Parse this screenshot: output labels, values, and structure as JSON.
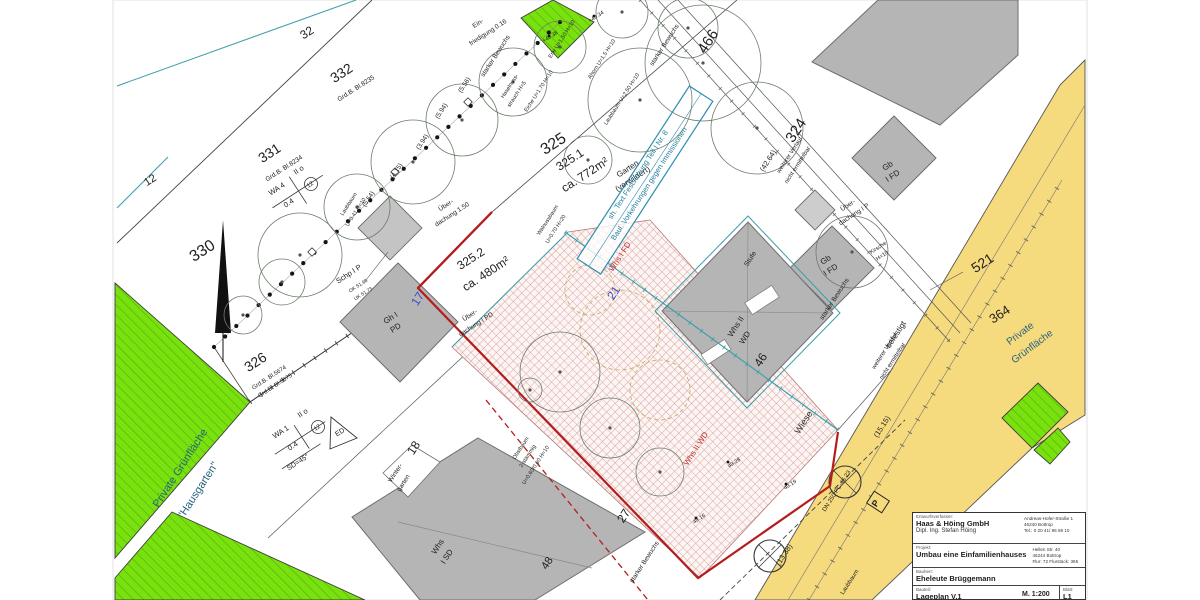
{
  "title_block": {
    "designer_label": "Entwurfsverfasser:",
    "designer_name": "Haas & Höing GmbH",
    "designer_person": "Dipl. Ing. Stefan Höing",
    "designer_addr1": "Andreas-Hofer-Straße 1",
    "designer_addr2": "46240 Bottrop",
    "designer_addr3": "Tel.: 0 20 41/ 96 69 10",
    "project_label": "Projekt:",
    "project_name": "Umbau eine Einfamilienhauses",
    "project_addr1": "Hellen Str. 40",
    "project_addr2": "46244 Bottrop",
    "project_addr3": "Flur: 72   Flurstück: 365",
    "client_label": "Bauherr:",
    "client_name": "Eheleute Brüggemann",
    "part_label": "Bauteil:",
    "part_name": "Lageplan V.1",
    "scale": "M. 1:200",
    "sheet_label": "Blatt:",
    "sheet": "L1"
  },
  "colors": {
    "green_area": "#79e20e",
    "green_hatch": "#5cb80b",
    "street_yellow": "#f5da7e",
    "building_grey": "#b5b5b5",
    "boundary_red": "#b51d1d",
    "hatch_pink": "#cf8f8c",
    "teal_line": "#3a9ea8",
    "green_text": "#27637d",
    "note_blue": "#1f7e9c",
    "blue_number": "#3b4fc0",
    "red_label": "#c03030"
  },
  "plan": {
    "labels": [
      {
        "name": "parcel-330",
        "text": "330",
        "x": 205,
        "y": 255,
        "rot": -33,
        "size": 16
      },
      {
        "name": "parcel-331",
        "text": "331",
        "x": 272,
        "y": 157,
        "rot": -33,
        "size": 14
      },
      {
        "name": "grundbuch-331",
        "text": "Grd.B. Bl.8234",
        "x": 285,
        "y": 170,
        "rot": -33,
        "size": 6.5
      },
      {
        "name": "parcel-332",
        "text": "332",
        "x": 344,
        "y": 77,
        "rot": -33,
        "size": 14
      },
      {
        "name": "grundbuch-332",
        "text": "Grd.B. Bl.8235",
        "x": 357,
        "y": 90,
        "rot": -33,
        "size": 6.5
      },
      {
        "name": "parcel-32",
        "text": "32",
        "x": 309,
        "y": 36,
        "rot": -33,
        "size": 12
      },
      {
        "name": "parcel-12",
        "text": "12",
        "x": 152,
        "y": 183,
        "rot": -33,
        "size": 11
      },
      {
        "name": "parcel-326",
        "text": "326",
        "x": 258,
        "y": 366,
        "rot": -33,
        "size": 14
      },
      {
        "name": "grundbuch-326a",
        "text": "Grd.B. Bl.5674",
        "x": 270,
        "y": 379,
        "rot": -33,
        "size": 6
      },
      {
        "name": "grundbuch-326b",
        "text": "Grd.B. Bl.5675",
        "x": 276,
        "y": 387,
        "rot": -33,
        "size": 6
      },
      {
        "name": "parcel-325",
        "text": "325",
        "x": 556,
        "y": 148,
        "rot": -33,
        "size": 16
      },
      {
        "name": "parcel-325-1",
        "text": "325.1",
        "x": 572,
        "y": 163,
        "rot": -33,
        "size": 12
      },
      {
        "name": "area-325-1",
        "text": "ca. 772m²",
        "x": 587,
        "y": 178,
        "rot": -33,
        "size": 12
      },
      {
        "name": "garten-label-1",
        "text": "Garten",
        "x": 629,
        "y": 171,
        "rot": -33,
        "size": 8
      },
      {
        "name": "garten-label-2",
        "text": "(verwildert)",
        "x": 634,
        "y": 181,
        "rot": -33,
        "size": 8
      },
      {
        "name": "parcel-325-2",
        "text": "325.2",
        "x": 473,
        "y": 262,
        "rot": -33,
        "size": 12
      },
      {
        "name": "area-325-2",
        "text": "ca. 480m²",
        "x": 488,
        "y": 277,
        "rot": -33,
        "size": 12
      },
      {
        "name": "parcel-324",
        "text": "324",
        "x": 800,
        "y": 133,
        "rot": -57,
        "size": 15
      },
      {
        "name": "parcel-466",
        "text": "466",
        "x": 712,
        "y": 44,
        "rot": -57,
        "size": 15
      },
      {
        "name": "parcel-521",
        "text": "521",
        "x": 985,
        "y": 267,
        "rot": -33,
        "size": 14
      },
      {
        "name": "parcel-364",
        "text": "364",
        "x": 1002,
        "y": 318,
        "rot": -33,
        "size": 13
      },
      {
        "name": "green-right-label-1",
        "text": "Private",
        "x": 1022,
        "y": 336,
        "rot": -37,
        "size": 10,
        "color": "#27637d"
      },
      {
        "name": "green-right-label-2",
        "text": "Grünfläche",
        "x": 1034,
        "y": 349,
        "rot": -37,
        "size": 10,
        "color": "#27637d"
      },
      {
        "name": "green-left-label-1",
        "text": "Private Grünfläche",
        "x": 183,
        "y": 470,
        "rot": -57,
        "size": 11,
        "color": "#27637d"
      },
      {
        "name": "green-left-label-2",
        "text": "\"Hausgarten\"",
        "x": 201,
        "y": 492,
        "rot": -57,
        "size": 11,
        "color": "#27637d"
      },
      {
        "name": "parcel-18",
        "text": "18",
        "x": 417,
        "y": 450,
        "rot": -57,
        "size": 12
      },
      {
        "name": "housenr-17",
        "text": "17",
        "x": 421,
        "y": 301,
        "rot": -57,
        "size": 12,
        "color": "#3b4fc0"
      },
      {
        "name": "housenr-21",
        "text": "21",
        "x": 617,
        "y": 295,
        "rot": -57,
        "size": 12,
        "color": "#3b4fc0"
      },
      {
        "name": "housenr-27",
        "text": "27",
        "x": 627,
        "y": 518,
        "rot": -57,
        "size": 12
      },
      {
        "name": "housenr-46",
        "text": "46",
        "x": 764,
        "y": 362,
        "rot": -57,
        "size": 12
      },
      {
        "name": "whs46-label-1",
        "text": "Whs II",
        "x": 738,
        "y": 328,
        "rot": -57,
        "size": 8
      },
      {
        "name": "whs46-label-2",
        "text": "WD",
        "x": 747,
        "y": 339,
        "rot": -57,
        "size": 8
      },
      {
        "name": "housenr-48",
        "text": "48",
        "x": 550,
        "y": 565,
        "rot": -57,
        "size": 11
      },
      {
        "name": "whs48-label-1",
        "text": "Whs",
        "x": 440,
        "y": 548,
        "rot": -57,
        "size": 8
      },
      {
        "name": "whs48-label-2",
        "text": "I SD",
        "x": 449,
        "y": 558,
        "rot": -57,
        "size": 8
      },
      {
        "name": "wintergarten-1",
        "text": "Winter-",
        "x": 397,
        "y": 474,
        "rot": -57,
        "size": 6.5
      },
      {
        "name": "wintergarten-2",
        "text": "garten",
        "x": 405,
        "y": 484,
        "rot": -57,
        "size": 6.5
      },
      {
        "name": "gb1-label-1",
        "text": "Gb",
        "x": 889,
        "y": 168,
        "rot": -33,
        "size": 8
      },
      {
        "name": "gb1-label-2",
        "text": "I FD",
        "x": 894,
        "y": 178,
        "rot": -33,
        "size": 8
      },
      {
        "name": "gb2-label-1",
        "text": "Gb",
        "x": 827,
        "y": 262,
        "rot": -33,
        "size": 8
      },
      {
        "name": "gb2-label-2",
        "text": "I FD",
        "x": 832,
        "y": 272,
        "rot": -33,
        "size": 8
      },
      {
        "name": "gh-label-1",
        "text": "Gh I",
        "x": 392,
        "y": 320,
        "rot": -33,
        "size": 8
      },
      {
        "name": "gh-label-2",
        "text": "PD",
        "x": 397,
        "y": 330,
        "rot": -33,
        "size": 8
      },
      {
        "name": "schp-label",
        "text": "Schp I P",
        "x": 350,
        "y": 276,
        "rot": -33,
        "size": 7.5
      },
      {
        "name": "schp-ok",
        "text": "OK 51.98",
        "x": 359,
        "y": 287,
        "rot": -33,
        "size": 5
      },
      {
        "name": "schp-uk",
        "text": "UK 51.73",
        "x": 364,
        "y": 295,
        "rot": -33,
        "size": 5
      },
      {
        "name": "ueberdachung1-1",
        "text": "Über-",
        "x": 447,
        "y": 207,
        "rot": -33,
        "size": 6.5
      },
      {
        "name": "ueberdachung1-2",
        "text": "dachung 1.50",
        "x": 453,
        "y": 216,
        "rot": -33,
        "size": 6.5
      },
      {
        "name": "ueberdachung2-1",
        "text": "Über-",
        "x": 471,
        "y": 317,
        "rot": -33,
        "size": 6.5
      },
      {
        "name": "ueberdachung2-2",
        "text": "dachung I PD",
        "x": 477,
        "y": 326,
        "rot": -33,
        "size": 6.5
      },
      {
        "name": "ueberdachung3-1",
        "text": "Über-",
        "x": 849,
        "y": 207,
        "rot": -33,
        "size": 6.5
      },
      {
        "name": "ueberdachung3-2",
        "text": "dachung I P",
        "x": 855,
        "y": 216,
        "rot": -33,
        "size": 6.5
      },
      {
        "name": "stufe-label",
        "text": "Stufe",
        "x": 752,
        "y": 260,
        "rot": -57,
        "size": 7
      },
      {
        "name": "befestigt-label",
        "text": "befestigt",
        "x": 898,
        "y": 336,
        "rot": -57,
        "size": 8
      },
      {
        "name": "wiese-label",
        "text": "Wiese",
        "x": 806,
        "y": 424,
        "rot": -57,
        "size": 9
      },
      {
        "name": "bewuchs-1",
        "text": "starker Bewuchs",
        "x": 497,
        "y": 57,
        "rot": -57,
        "size": 6.5
      },
      {
        "name": "bewuchs-2",
        "text": "starker Bewuchs",
        "x": 666,
        "y": 46,
        "rot": -57,
        "size": 6.5
      },
      {
        "name": "bewuchs-3",
        "text": "starker Bewuchs",
        "x": 836,
        "y": 300,
        "rot": -57,
        "size": 6.5
      },
      {
        "name": "bewuchs-4",
        "text": "starker Bewuchs",
        "x": 646,
        "y": 563,
        "rot": -57,
        "size": 6.5
      },
      {
        "name": "verlauf-1a",
        "text": "weiterer Verlauf",
        "x": 791,
        "y": 156,
        "rot": -57,
        "size": 6
      },
      {
        "name": "verlauf-1b",
        "text": "nicht ermittelbar",
        "x": 799,
        "y": 166,
        "rot": -57,
        "size": 6
      },
      {
        "name": "verlauf-2a",
        "text": "weiterer Verlauf",
        "x": 886,
        "y": 352,
        "rot": -57,
        "size": 6
      },
      {
        "name": "verlauf-2b",
        "text": "nicht ermittelbar",
        "x": 894,
        "y": 362,
        "rot": -57,
        "size": 6
      },
      {
        "name": "dim-42-64",
        "text": "(42.64)",
        "x": 770,
        "y": 162,
        "rot": -57,
        "size": 7.5
      },
      {
        "name": "dim-13-38",
        "text": "(13.38)",
        "x": 786,
        "y": 556,
        "rot": -57,
        "size": 7.5
      },
      {
        "name": "dim-15-15",
        "text": "(15.15)",
        "x": 884,
        "y": 428,
        "rot": -57,
        "size": 7.5
      },
      {
        "name": "dim-5-56",
        "text": "(5.56)",
        "x": 466,
        "y": 86,
        "rot": -57,
        "size": 6.5
      },
      {
        "name": "dim-5-94",
        "text": "(5.94)",
        "x": 443,
        "y": 112,
        "rot": -57,
        "size": 6.5
      },
      {
        "name": "dim-3-94",
        "text": "(3.94)",
        "x": 424,
        "y": 143,
        "rot": -57,
        "size": 6.5
      },
      {
        "name": "dim-4-15",
        "text": "(4.15)",
        "x": 398,
        "y": 172,
        "rot": -57,
        "size": 6.5
      },
      {
        "name": "dim-5-54",
        "text": "(5.54)",
        "x": 370,
        "y": 200,
        "rot": -57,
        "size": 6.5
      },
      {
        "name": "einfriedigung-1",
        "text": "Ein-",
        "x": 479,
        "y": 25,
        "rot": -33,
        "size": 6.5
      },
      {
        "name": "einfriedigung-2",
        "text": "friedigung 0.16",
        "x": 489,
        "y": 34,
        "rot": -33,
        "size": 6.5
      },
      {
        "name": "note-line-1",
        "text": "sh. Text Festsetzung Teil I Nr. 8",
        "x": 640,
        "y": 176,
        "rot": -57,
        "size": 7.5,
        "color": "#1f7e9c"
      },
      {
        "name": "note-line-2",
        "text": "Baul. Vorkehrungen gegen Immissionen",
        "x": 651,
        "y": 185,
        "rot": -57,
        "size": 7.5,
        "color": "#1f7e9c"
      },
      {
        "name": "whs-red-1",
        "text": "Whs I FD",
        "x": 622,
        "y": 258,
        "rot": -57,
        "size": 8,
        "color": "#c03030"
      },
      {
        "name": "whs-red-2",
        "text": "Whs II WD",
        "x": 698,
        "y": 450,
        "rot": -57,
        "size": 8,
        "color": "#c03030"
      },
      {
        "name": "walnuss-1",
        "text": "Walnussbaum",
        "x": 549,
        "y": 221,
        "rot": -57,
        "size": 5.5
      },
      {
        "name": "walnuss-2",
        "text": "U=0.70 H=20",
        "x": 557,
        "y": 230,
        "rot": -57,
        "size": 5.5
      },
      {
        "name": "obstbaum-1",
        "text": "Obstbaum",
        "x": 522,
        "y": 449,
        "rot": -57,
        "size": 5.5
      },
      {
        "name": "obstbaum-2",
        "text": "2-stämmig",
        "x": 529,
        "y": 457,
        "rot": -57,
        "size": 5.5
      },
      {
        "name": "obstbaum-3",
        "text": "U=0.60/0.60 H=10",
        "x": 537,
        "y": 466,
        "rot": -57,
        "size": 5.5
      },
      {
        "name": "kirsche-1",
        "text": "Kirsche",
        "x": 879,
        "y": 249,
        "rot": -33,
        "size": 5.5
      },
      {
        "name": "kirsche-2",
        "text": "H=10",
        "x": 883,
        "y": 257,
        "rot": -33,
        "size": 5.5
      },
      {
        "name": "erle-label",
        "text": "Erle U=1.50 H=10",
        "x": 563,
        "y": 40,
        "rot": -57,
        "size": 5.5
      },
      {
        "name": "ahorn-label",
        "text": "Ahorn U=1.5 H=10",
        "x": 603,
        "y": 60,
        "rot": -57,
        "size": 5.5
      },
      {
        "name": "eiche-label",
        "text": "Eiche U=1.70 H=10",
        "x": 540,
        "y": 92,
        "rot": -57,
        "size": 5.5
      },
      {
        "name": "haselnuss-1",
        "text": "Haselnuss-",
        "x": 511,
        "y": 87,
        "rot": -57,
        "size": 5.5
      },
      {
        "name": "haselnuss-2",
        "text": "strauch H=5",
        "x": 518,
        "y": 95,
        "rot": -57,
        "size": 5.5
      },
      {
        "name": "laubbaum-1",
        "text": "Laubbaum",
        "x": 350,
        "y": 205,
        "rot": -57,
        "size": 5.5
      },
      {
        "name": "laubbaum-2",
        "text": "U=0.41 H=10",
        "x": 357,
        "y": 213,
        "rot": -57,
        "size": 5.5
      },
      {
        "name": "laubbaum-3",
        "text": "Laubbaum U=2.50 H=10",
        "x": 623,
        "y": 100,
        "rot": -57,
        "size": 5.5
      },
      {
        "name": "dn250-label",
        "text": "DN 250 PC-45 23",
        "x": 838,
        "y": 492,
        "rot": -57,
        "size": 6
      },
      {
        "name": "laubbaum-street",
        "text": "Laubbaum",
        "x": 851,
        "y": 583,
        "rot": -57,
        "size": 6
      },
      {
        "name": "p-sign-label",
        "text": "P",
        "x": 878,
        "y": 505,
        "rot": -57,
        "size": 9,
        "bold": true
      },
      {
        "name": "height-49-28",
        "text": "49.28",
        "x": 735,
        "y": 464,
        "rot": -33,
        "size": 5.5
      },
      {
        "name": "height-49-19",
        "text": "49.19",
        "x": 791,
        "y": 486,
        "rot": -33,
        "size": 5.5
      },
      {
        "name": "height-49-16",
        "text": "49.16",
        "x": 700,
        "y": 520,
        "rot": -33,
        "size": 5.5
      },
      {
        "name": "height-49-34",
        "text": "+49.34",
        "x": 597,
        "y": 18,
        "rot": -33,
        "size": 5.5
      },
      {
        "name": "height-49-38",
        "text": "+49.38",
        "x": 551,
        "y": 38,
        "rot": -33,
        "size": 5.5
      },
      {
        "name": "schablone1-wa",
        "text": "WA 4",
        "x": 278,
        "y": 191,
        "rot": -33,
        "size": 7.5
      },
      {
        "name": "schablone1-grz",
        "text": "0.4",
        "x": 290,
        "y": 205,
        "rot": -33,
        "size": 7.5
      },
      {
        "name": "schablone1-geschosse",
        "text": "II o",
        "x": 300,
        "y": 172,
        "rot": -33,
        "size": 7.5
      },
      {
        "name": "schablone1-12",
        "text": "12",
        "x": 311,
        "y": 186,
        "rot": -33,
        "size": 6
      },
      {
        "name": "schablone2-wa",
        "text": "WA 1",
        "x": 282,
        "y": 434,
        "rot": -33,
        "size": 7.5
      },
      {
        "name": "schablone2-grz",
        "text": "0.4",
        "x": 294,
        "y": 448,
        "rot": -33,
        "size": 7.5
      },
      {
        "name": "schablone2-geschosse",
        "text": "II o",
        "x": 304,
        "y": 415,
        "rot": -33,
        "size": 7.5
      },
      {
        "name": "schablone2-12",
        "text": "12",
        "x": 318,
        "y": 429,
        "rot": -33,
        "size": 6
      },
      {
        "name": "schablone2-sd45",
        "text": "SD=45°",
        "x": 299,
        "y": 464,
        "rot": -33,
        "size": 7
      },
      {
        "name": "ed-label",
        "text": "ED",
        "x": 341,
        "y": 434,
        "rot": -33,
        "size": 7
      }
    ],
    "trees": [
      [
        300,
        255,
        42
      ],
      [
        357,
        207,
        33
      ],
      [
        413,
        162,
        42
      ],
      [
        462,
        120,
        36
      ],
      [
        513,
        82,
        34
      ],
      [
        560,
        47,
        26
      ],
      [
        640,
        100,
        52
      ],
      [
        703,
        63,
        58
      ],
      [
        757,
        128,
        46
      ],
      [
        688,
        28,
        30
      ],
      [
        622,
        12,
        26
      ],
      [
        588,
        160,
        24
      ],
      [
        852,
        252,
        36
      ],
      [
        560,
        372,
        40
      ],
      [
        610,
        428,
        30
      ],
      [
        530,
        390,
        12
      ],
      [
        660,
        472,
        24
      ],
      [
        243,
        315,
        19
      ],
      [
        282,
        282,
        23
      ]
    ]
  }
}
